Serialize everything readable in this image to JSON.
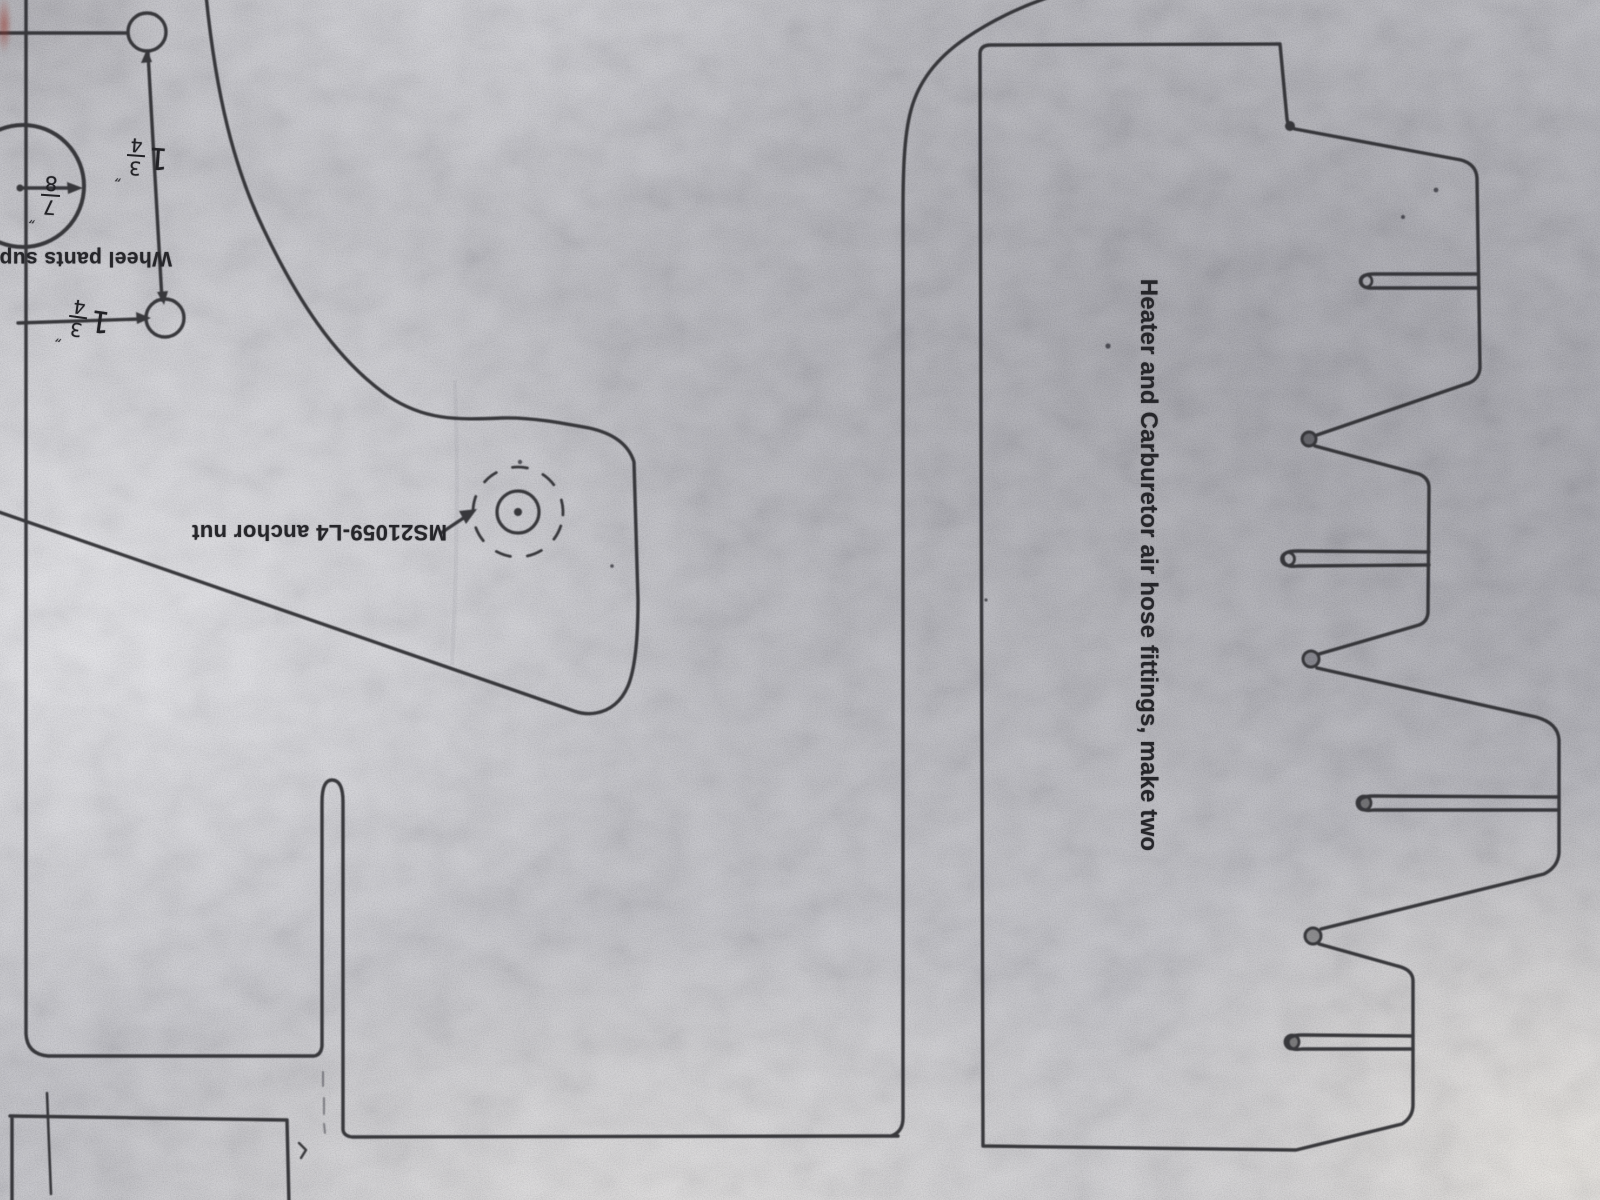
{
  "labels": {
    "wheel_pants": "Wheel pants supp",
    "anchor_nut": "MS21059-L4 anchor nut",
    "heater": "Heater and Carburetor air hose fittings, make two"
  },
  "dimensions": {
    "dim_top": {
      "whole": "1",
      "num": "3",
      "den": "4",
      "ditto": "″"
    },
    "dim_bottom": {
      "whole": "1",
      "num": "3",
      "den": "4",
      "ditto": "″"
    },
    "hole": {
      "num": "7",
      "den": "8",
      "ditto": "″"
    }
  },
  "colors": {
    "paper": "#c6c6ca",
    "ink": "#2b2b2f"
  },
  "notes": {
    "wheel_pants_orientation": "rotated 180",
    "anchor_nut_orientation": "rotated 180",
    "heater_orientation": "rotated 90 clockwise"
  }
}
